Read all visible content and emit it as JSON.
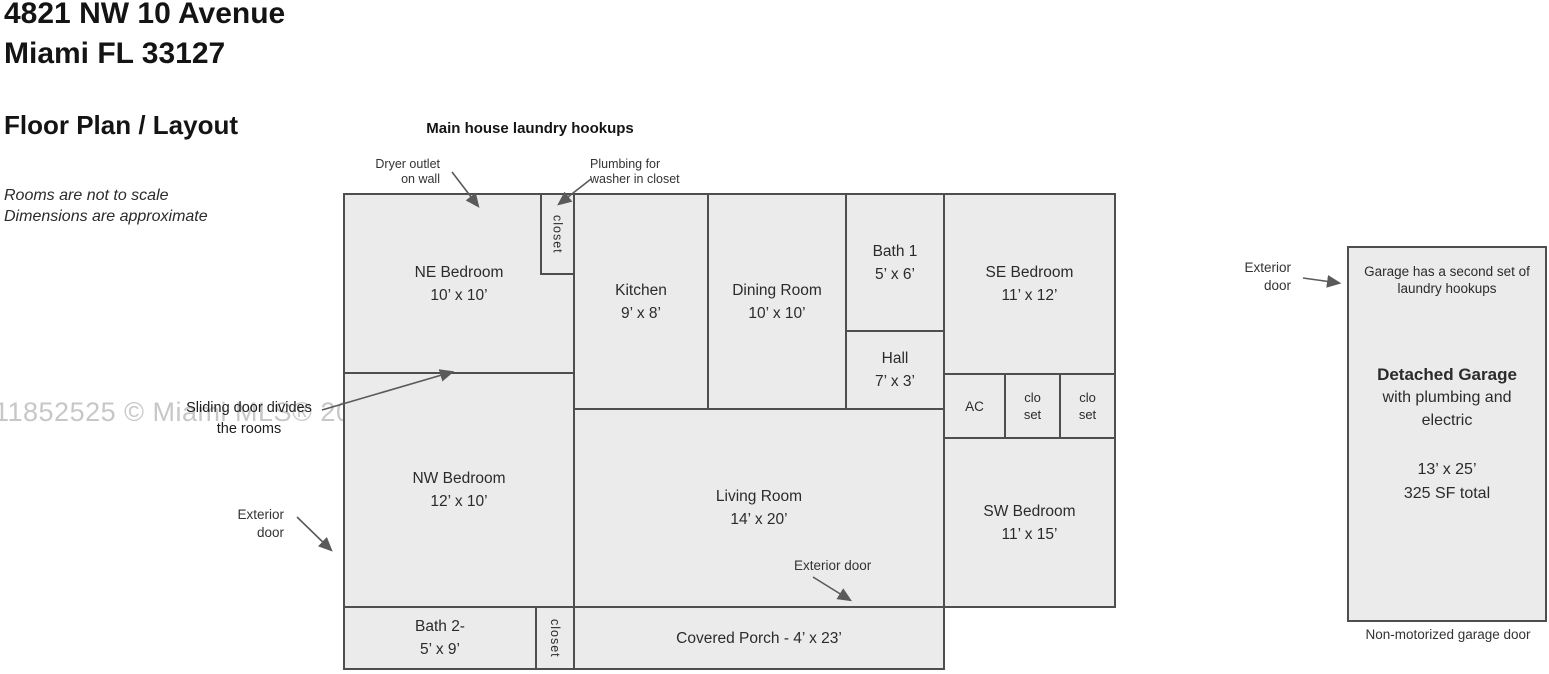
{
  "header": {
    "address_line1": "4821 NW 10 Avenue",
    "address_line2": "Miami FL 33127",
    "section_title": "Floor Plan / Layout",
    "note_line1": "Rooms are not to scale",
    "note_line2": "Dimensions are approximate"
  },
  "watermark": "11852525 © Miami MLS® 2025",
  "annotations": {
    "laundry_hookups_title": "Main house laundry hookups",
    "dryer_line1": "Dryer outlet",
    "dryer_line2": "on wall",
    "plumbing_line1": "Plumbing for",
    "plumbing_line2": "washer in closet",
    "sliding_line1": "Sliding door divides",
    "sliding_line2": "the rooms",
    "exterior_door_nw_line1": "Exterior",
    "exterior_door_nw_line2": "door",
    "exterior_door_living": "Exterior door",
    "exterior_door_garage_line1": "Exterior",
    "exterior_door_garage_line2": "door"
  },
  "rooms": {
    "ne_bedroom": {
      "name": "NE Bedroom",
      "dims": "10’ x 10’"
    },
    "laundry_closet": {
      "name": "closet"
    },
    "kitchen": {
      "name": "Kitchen",
      "dims": "9’ x 8’"
    },
    "dining_room": {
      "name": "Dining Room",
      "dims": "10’ x 10’"
    },
    "bath1": {
      "name": "Bath 1",
      "dims": "5’ x 6’"
    },
    "hall": {
      "name": "Hall",
      "dims": "7’ x 3’"
    },
    "se_bedroom": {
      "name": "SE Bedroom",
      "dims": "11’ x 12’"
    },
    "ac": {
      "name": "AC"
    },
    "closet_a": {
      "line1": "clo",
      "line2": "set"
    },
    "closet_b": {
      "line1": "clo",
      "line2": "set"
    },
    "nw_bedroom": {
      "name": "NW Bedroom",
      "dims": "12’ x 10’"
    },
    "living_room": {
      "name": "Living Room",
      "dims": "14’ x 20’"
    },
    "sw_bedroom": {
      "name": "SW Bedroom",
      "dims": "11’ x 15’"
    },
    "bath2": {
      "name": "Bath 2-",
      "dims": "5’ x 9’"
    },
    "bath2_closet": {
      "name": "closet"
    },
    "covered_porch": {
      "name": "Covered Porch - 4’ x 23’"
    }
  },
  "garage": {
    "note_line1": "Garage has a second set of",
    "note_line2": "laundry hookups",
    "title": "Detached Garage",
    "sub_line1": "with plumbing and",
    "sub_line2": "electric",
    "dims_line1": "13’ x 25’",
    "dims_line2": "325 SF total",
    "door_label": "Non-motorized garage door"
  },
  "colors": {
    "room_fill": "#ebebeb",
    "wall": "#4e4e4e",
    "arrow": "#5a5a5a",
    "watermark": "#c2c2c2"
  }
}
